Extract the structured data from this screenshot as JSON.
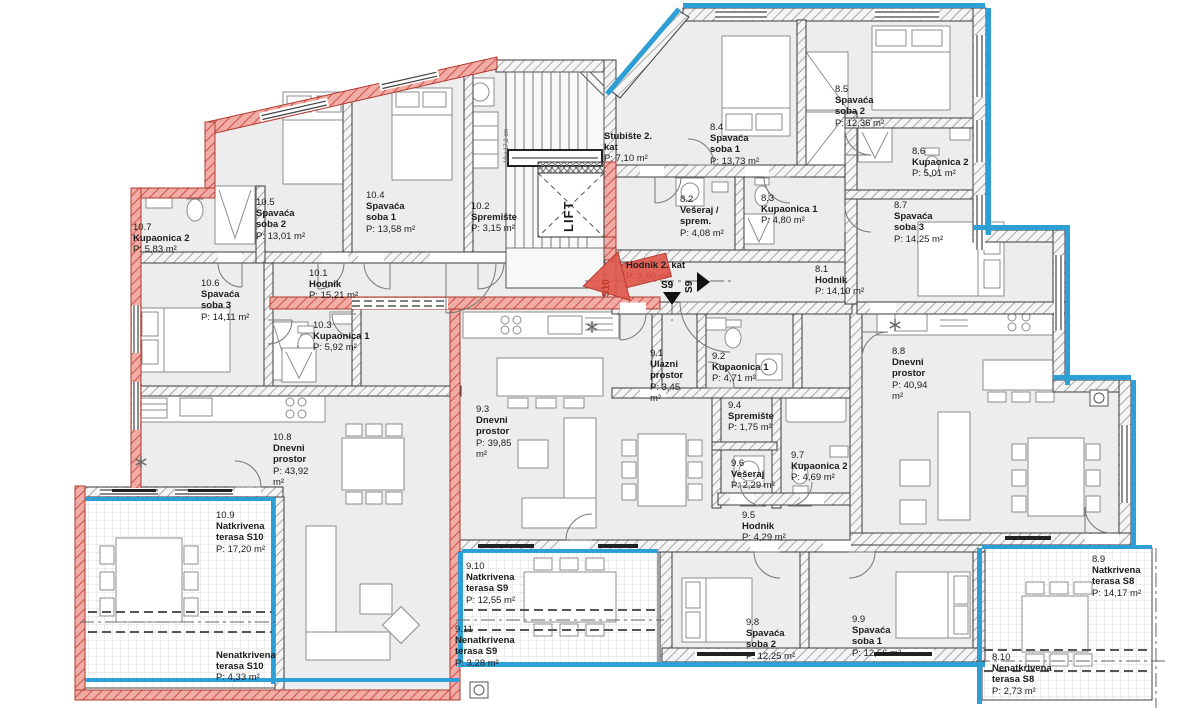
{
  "colors": {
    "unit_s10_highlight": "#cf4a41",
    "unit_s10_hatch_fill": "#f2aea7",
    "facade_blue": "#2d9fd6",
    "wall_edge": "#3c3c3c",
    "room_fill": "#ededed"
  },
  "units": [
    {
      "name": "S10",
      "rooms": [
        {
          "id": "10.1",
          "name": "Hodnik",
          "area": "P: 15,21 m²",
          "x": 309,
          "y": 268,
          "w": 70
        },
        {
          "id": "10.2",
          "name": "Spremište",
          "area": "P: 3,15 m²",
          "x": 471,
          "y": 201,
          "w": 60
        },
        {
          "id": "10.3",
          "name": "Kupaonica 1",
          "area": "P: 5,92 m²",
          "x": 313,
          "y": 320,
          "w": 70
        },
        {
          "id": "10.4",
          "name": "Spavaća soba 1",
          "area": "P: 13,58 m²",
          "x": 366,
          "y": 190,
          "w": 50
        },
        {
          "id": "10.5",
          "name": "Spavaća soba 2",
          "area": "P: 13,01 m²",
          "x": 256,
          "y": 197,
          "w": 50
        },
        {
          "id": "10.6",
          "name": "Spavaća soba 3",
          "area": "P: 14,11 m²",
          "x": 201,
          "y": 278,
          "w": 50
        },
        {
          "id": "10.7",
          "name": "Kupaonica 2",
          "area": "P: 5,83 m²",
          "x": 133,
          "y": 222,
          "w": 70
        },
        {
          "id": "10.8",
          "name": "Dnevni prostor",
          "area": "P: 43,92 m²",
          "x": 273,
          "y": 432,
          "w": 46
        },
        {
          "id": "10.9",
          "name": "Natkrivena terasa S10",
          "area": "P: 17,20 m²",
          "x": 216,
          "y": 510,
          "w": 64
        },
        {
          "id": "",
          "name": "Nenatkrivena terasa S10",
          "area": "P: 4,33 m²",
          "x": 216,
          "y": 650,
          "w": 72
        }
      ]
    },
    {
      "name": "S9",
      "rooms": [
        {
          "id": "9.1",
          "name": "Ulazni prostor",
          "area": "P: 3,45 m²",
          "x": 650,
          "y": 348,
          "w": 42
        },
        {
          "id": "9.2",
          "name": "Kupaonica 1",
          "area": "P: 4,71 m²",
          "x": 712,
          "y": 351,
          "w": 70
        },
        {
          "id": "9.3",
          "name": "Dnevni prostor",
          "area": "P: 39,85 m²",
          "x": 476,
          "y": 404,
          "w": 46
        },
        {
          "id": "9.4",
          "name": "Spremište",
          "area": "P: 1,75 m²",
          "x": 728,
          "y": 400,
          "w": 60
        },
        {
          "id": "9.5",
          "name": "Hodnik",
          "area": "P: 4,29 m²",
          "x": 742,
          "y": 510,
          "w": 70
        },
        {
          "id": "9.6",
          "name": "Vešeraj",
          "area": "P: 2,29 m²",
          "x": 731,
          "y": 458,
          "w": 60
        },
        {
          "id": "9.7",
          "name": "Kupaonica 2",
          "area": "P: 4,69 m²",
          "x": 791,
          "y": 450,
          "w": 70
        },
        {
          "id": "9.8",
          "name": "Spavaća soba 2",
          "area": "P: 12,25 m²",
          "x": 746,
          "y": 617,
          "w": 50
        },
        {
          "id": "9.9",
          "name": "Spavaća soba 1",
          "area": "P: 12,56 m²",
          "x": 852,
          "y": 614,
          "w": 50
        },
        {
          "id": "9.10",
          "name": "Natkrivena terasa S9",
          "area": "P: 12,55 m²",
          "x": 466,
          "y": 561,
          "w": 62
        },
        {
          "id": "9.11",
          "name": "Nenatkrivena terasa S9",
          "area": "P: 3,28 m²",
          "x": 455,
          "y": 624,
          "w": 72
        }
      ]
    },
    {
      "name": "S8",
      "rooms": [
        {
          "id": "8.1",
          "name": "Hodnik",
          "area": "P: 14,10 m²",
          "x": 815,
          "y": 264,
          "w": 70
        },
        {
          "id": "8.2",
          "name": "Vešeraj / sprem.",
          "area": "P: 4,08 m²",
          "x": 680,
          "y": 194,
          "w": 50
        },
        {
          "id": "8.3",
          "name": "Kupaonica 1",
          "area": "P: 4,80 m²",
          "x": 761,
          "y": 193,
          "w": 70
        },
        {
          "id": "8.4",
          "name": "Spavaća soba 1",
          "area": "P: 13,73 m²",
          "x": 710,
          "y": 122,
          "w": 50
        },
        {
          "id": "8.5",
          "name": "Spavaća soba 2",
          "area": "P: 12,36 m²",
          "x": 835,
          "y": 84,
          "w": 50
        },
        {
          "id": "8.6",
          "name": "Kupaonica 2",
          "area": "P: 5,01 m²",
          "x": 912,
          "y": 146,
          "w": 70
        },
        {
          "id": "8.7",
          "name": "Spavaća soba 3",
          "area": "P: 14,25 m²",
          "x": 894,
          "y": 200,
          "w": 50
        },
        {
          "id": "8.8",
          "name": "Dnevni prostor",
          "area": "P: 40,94 m²",
          "x": 892,
          "y": 346,
          "w": 46
        },
        {
          "id": "8.9",
          "name": "Natkrivena terasa S8",
          "area": "P: 14,17 m²",
          "x": 1092,
          "y": 554,
          "w": 62
        },
        {
          "id": "8.10",
          "name": "Nenatkrivena terasa S8",
          "area": "P: 2,73 m²",
          "x": 992,
          "y": 652,
          "w": 72
        }
      ]
    },
    {
      "name": "common",
      "rooms": [
        {
          "id": "",
          "name": "Stubište 2. kat",
          "area": "P: 7,10 m²",
          "x": 604,
          "y": 131,
          "w": 56
        },
        {
          "id": "",
          "name": "LIFT",
          "area": "",
          "x": 561,
          "y": 232,
          "rot": -90,
          "cls": "lift"
        },
        {
          "id": "",
          "name": "Hodnik 2. kat",
          "area": "P: 3,60 m²",
          "x": 626,
          "y": 260,
          "w": 90,
          "cls": "red-area"
        }
      ]
    }
  ],
  "section_markers": [
    {
      "label": "S10",
      "x": 601,
      "y": 297,
      "rot": -90,
      "cls": "s10"
    },
    {
      "label": "S9",
      "x": 684,
      "y": 293,
      "rot": -90,
      "cls": "s9"
    },
    {
      "label": "S9",
      "x": 661,
      "y": 280,
      "rot": 0,
      "cls": "s9"
    }
  ],
  "stair_note": {
    "text": "18 x 17,2 cm",
    "x": 504,
    "y": 163
  }
}
